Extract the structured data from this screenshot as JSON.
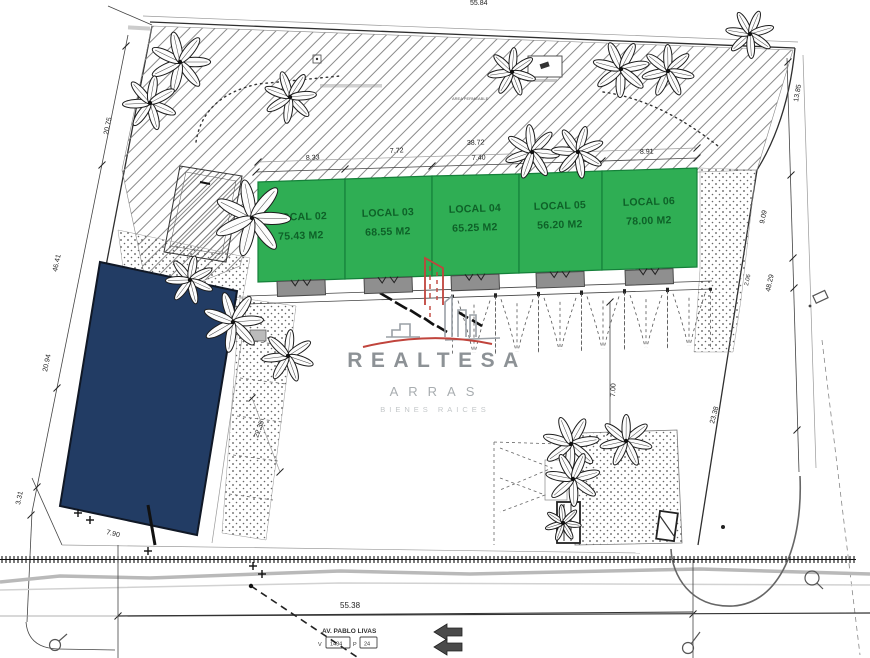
{
  "locals": [
    {
      "name": "LOCAL 02",
      "area": "75.43 M2"
    },
    {
      "name": "LOCAL 03",
      "area": "68.55 M2"
    },
    {
      "name": "LOCAL 04",
      "area": "65.25 M2"
    },
    {
      "name": "LOCAL 05",
      "area": "56.20 M2"
    },
    {
      "name": "LOCAL 06",
      "area": "78.00 M2"
    }
  ],
  "dims": {
    "top_edge": "55.84",
    "left": [
      "20.75",
      "46.41",
      "20.94",
      "3.31"
    ],
    "top": [
      "8.33",
      "7.72",
      "38.72",
      "7.40",
      "8.91"
    ],
    "right": [
      "13.85",
      "9.09",
      "2.06",
      "48.29",
      "23.38"
    ],
    "middle": {
      "left_aisle": "22.35",
      "drive": "7.00",
      "bottom": "7.90",
      "frontage": "55.38"
    }
  },
  "street": {
    "name": "AV. PABLO LIVAS",
    "v_label": "V",
    "v_value": "1434",
    "p_label": "P",
    "p_value": "24"
  },
  "notes": {
    "area_permeable": "AREA PERMEABLE"
  },
  "watermark": {
    "brand": "REALTESA",
    "division": "ARRAS",
    "tagline": "BIENES RAICES"
  },
  "colors": {
    "local_fill": "#2fae54",
    "local_border": "#15803a",
    "local_text": "#0e6128",
    "reserved_fill": "#223c64",
    "stall_fill": "#8f8f8f",
    "watermark_red": "#c0443c",
    "watermark_gray": "#8d9296"
  }
}
